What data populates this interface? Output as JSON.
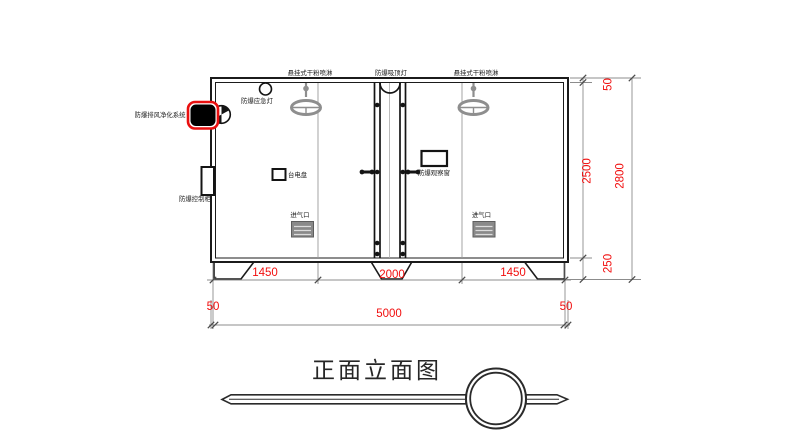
{
  "drawing": {
    "title": "正面立面图",
    "labels": {
      "sprinkler_left": "悬挂式干粉喷淋",
      "ceiling_light": "防爆吸顶灯",
      "sprinkler_right": "悬挂式干粉喷淋",
      "emergency_light": "防爆应急灯",
      "exhaust_system": "防爆排风净化系统",
      "control_cabinet": "防爆控制柜",
      "power_panel": "台电盘",
      "observation_window": "防爆观察窗",
      "air_inlet_left": "进气口",
      "air_inlet_right": "进气口"
    },
    "dims": {
      "seg_left": "1450",
      "seg_mid": "2000",
      "seg_right": "1450",
      "wall_left": "50",
      "total_width": "5000",
      "wall_right": "50",
      "roof": "50",
      "inner_height": "2500",
      "base": "250",
      "total_height": "2800"
    },
    "colors": {
      "dimension_text": "#f10e0e",
      "highlight_outline": "#e90f0f",
      "line": "#1b1b1b",
      "hardware_gray": "#8e8e8e"
    }
  }
}
